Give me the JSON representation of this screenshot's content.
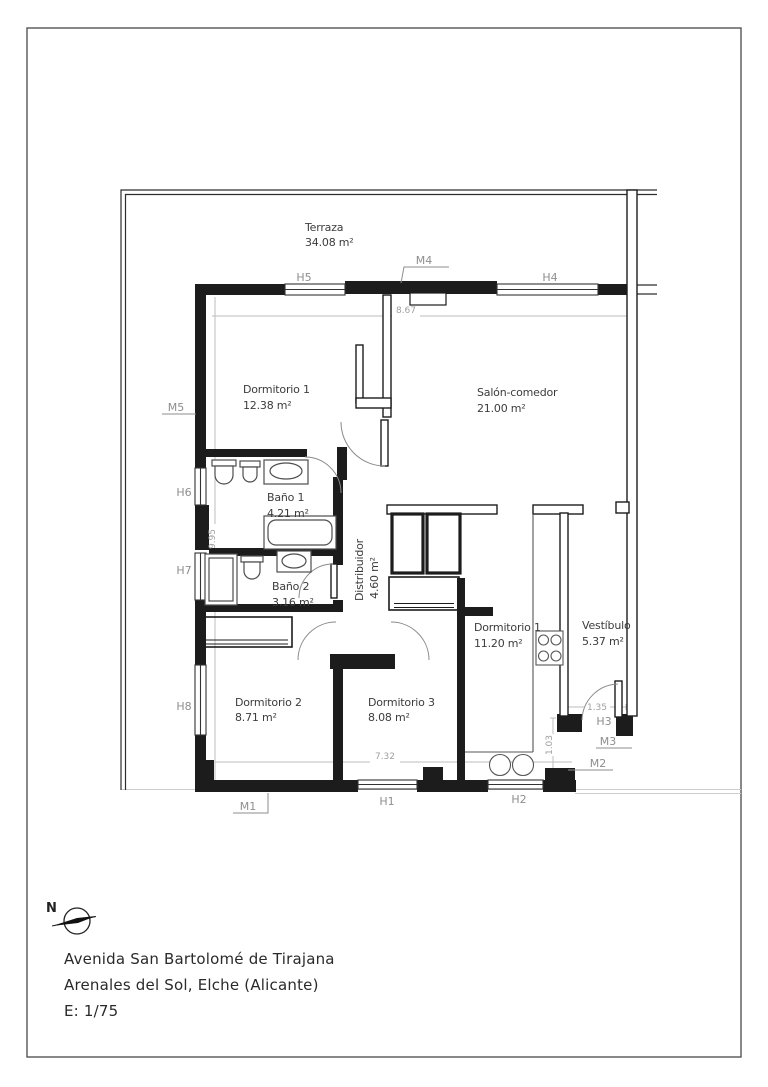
{
  "rooms": {
    "terraza": {
      "name": "Terraza",
      "area": "34.08 m²"
    },
    "dormitorio1": {
      "name": "Dormitorio 1",
      "area": "12.38 m²"
    },
    "salon": {
      "name": "Salón-comedor",
      "area": "21.00 m²"
    },
    "bano1": {
      "name": "Baño 1",
      "area": "4.21 m²"
    },
    "bano2": {
      "name": "Baño 2",
      "area": "3.16 m²"
    },
    "distribuidor": {
      "name": "Distribuidor",
      "area": "4.60 m²"
    },
    "dormitorio1b": {
      "name": "Dormitorio 1",
      "area": "11.20 m²"
    },
    "vestibulo": {
      "name": "Vestíbulo",
      "area": "5.37 m²"
    },
    "dormitorio2": {
      "name": "Dormitorio 2",
      "area": "8.71 m²"
    },
    "dormitorio3": {
      "name": "Dormitorio 3",
      "area": "8.08 m²"
    }
  },
  "openings": {
    "h1": "H1",
    "h2": "H2",
    "h3": "H3",
    "h4": "H4",
    "h5": "H5",
    "h6": "H6",
    "h7": "H7",
    "h8": "H8",
    "m1": "M1",
    "m2": "M2",
    "m3": "M3",
    "m4": "M4",
    "m5": "M5"
  },
  "dimensions": {
    "interior_width": "8.67",
    "interior_height": "9.95",
    "bottom_width": "7.32",
    "kitchen_depth": "1.03",
    "vestibulo_width": "1.35"
  },
  "title_block": {
    "north_label": "N",
    "address_line1": "Avenida San Bartolomé de Tirajana",
    "address_line2": "Arenales del Sol, Elche (Alicante)",
    "scale_label": "E: 1/75"
  },
  "colors": {
    "wall": "#1c1c1c",
    "label_gray": "#8e8e8e",
    "dim_gray": "#b5b5b5",
    "text": "#3c3c3c"
  }
}
